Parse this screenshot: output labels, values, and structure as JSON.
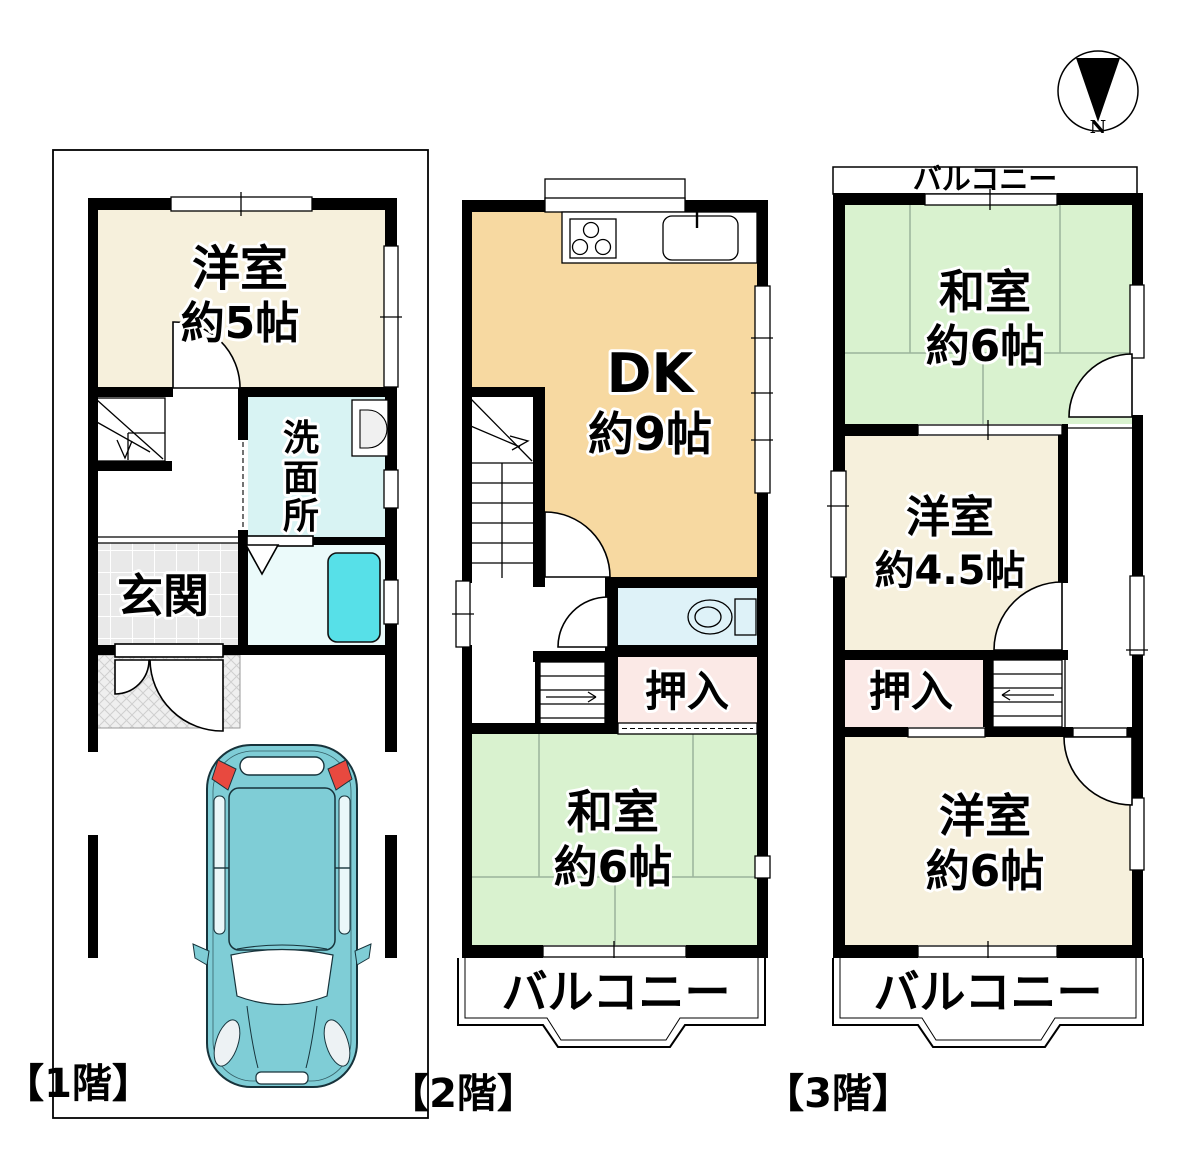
{
  "compass": {
    "label": "N"
  },
  "floor1": {
    "label": "【1階】",
    "western_room": {
      "name": "洋室",
      "size": "約5帖"
    },
    "washroom": {
      "chars": [
        "洗",
        "面",
        "所"
      ]
    },
    "entrance": {
      "name": "玄関"
    }
  },
  "floor2": {
    "label": "【2階】",
    "dk": {
      "name": "DK",
      "size": "約9帖"
    },
    "closet": {
      "name": "押入"
    },
    "japanese_room": {
      "name": "和室",
      "size": "約6帖"
    },
    "balcony": {
      "name": "バルコニー"
    }
  },
  "floor3": {
    "label": "【3階】",
    "balcony_top": {
      "name": "バルコニー"
    },
    "japanese_room": {
      "name": "和室",
      "size": "約6帖"
    },
    "western_room_small": {
      "name": "洋室",
      "size": "約4.5帖"
    },
    "closet": {
      "name": "押入"
    },
    "western_room": {
      "name": "洋室",
      "size": "約6帖"
    },
    "balcony_bottom": {
      "name": "バルコニー"
    }
  },
  "colors": {
    "wall": "#000000",
    "room_cream": "#f6f0dc",
    "room_dk": "#f7d9a1",
    "room_tatami": "#d9f2cf",
    "closet_pink": "#fbe9e6",
    "washroom_cyan": "#d8f3f3",
    "bath_cyan": "#ebfafa",
    "toilet_cyan": "#def2f8",
    "bathtub": "#57e0e8",
    "entrance_gray": "#e9e9e9",
    "car_body": "#7fcdd6",
    "car_light_red": "#e8493f",
    "tatami_line": "#9bb39b"
  }
}
